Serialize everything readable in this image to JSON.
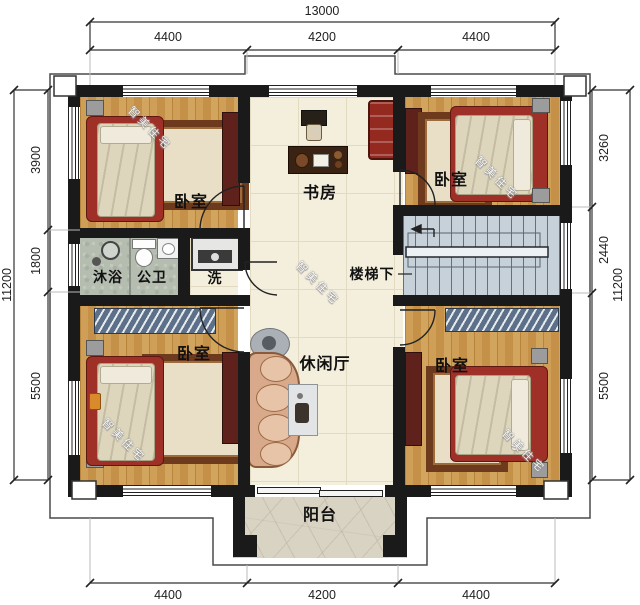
{
  "watermark": "智美住宅",
  "dims": {
    "top_total": "13000",
    "top_segments": [
      "4400",
      "4200",
      "4400"
    ],
    "bottom_segments": [
      "4400",
      "4200",
      "4400"
    ],
    "left_total": "11200",
    "left_segments": [
      "3900",
      "1800",
      "5500"
    ],
    "right_total": "11200",
    "right_segments": [
      "3260",
      "2440",
      "5500"
    ]
  },
  "rooms": {
    "bedroom_top_left": {
      "label": "卧室"
    },
    "study": {
      "label": "书房"
    },
    "bedroom_top_right": {
      "label": "卧室"
    },
    "shower": {
      "label": "沐浴"
    },
    "toilet": {
      "label": "公卫"
    },
    "laundry": {
      "label": "洗"
    },
    "under_stairs": {
      "label": "楼梯下"
    },
    "bedroom_bottom_left": {
      "label": "卧室"
    },
    "lounge": {
      "label": "休闲厅"
    },
    "bedroom_bottom_right": {
      "label": "卧室"
    },
    "balcony": {
      "label": "阳台"
    }
  },
  "colors": {
    "wall": "#1a1a1a",
    "wood_floor": "#c99a52",
    "tile_floor": "#f4eedd",
    "bath_floor": "#b5bcb0",
    "stair_floor": "#c7d1da",
    "balcony_floor": "#d9d3c3",
    "accent_red": "#9e3028",
    "cabinet_red": "#5f211c",
    "wardrobe_blue": "#5c7089"
  }
}
